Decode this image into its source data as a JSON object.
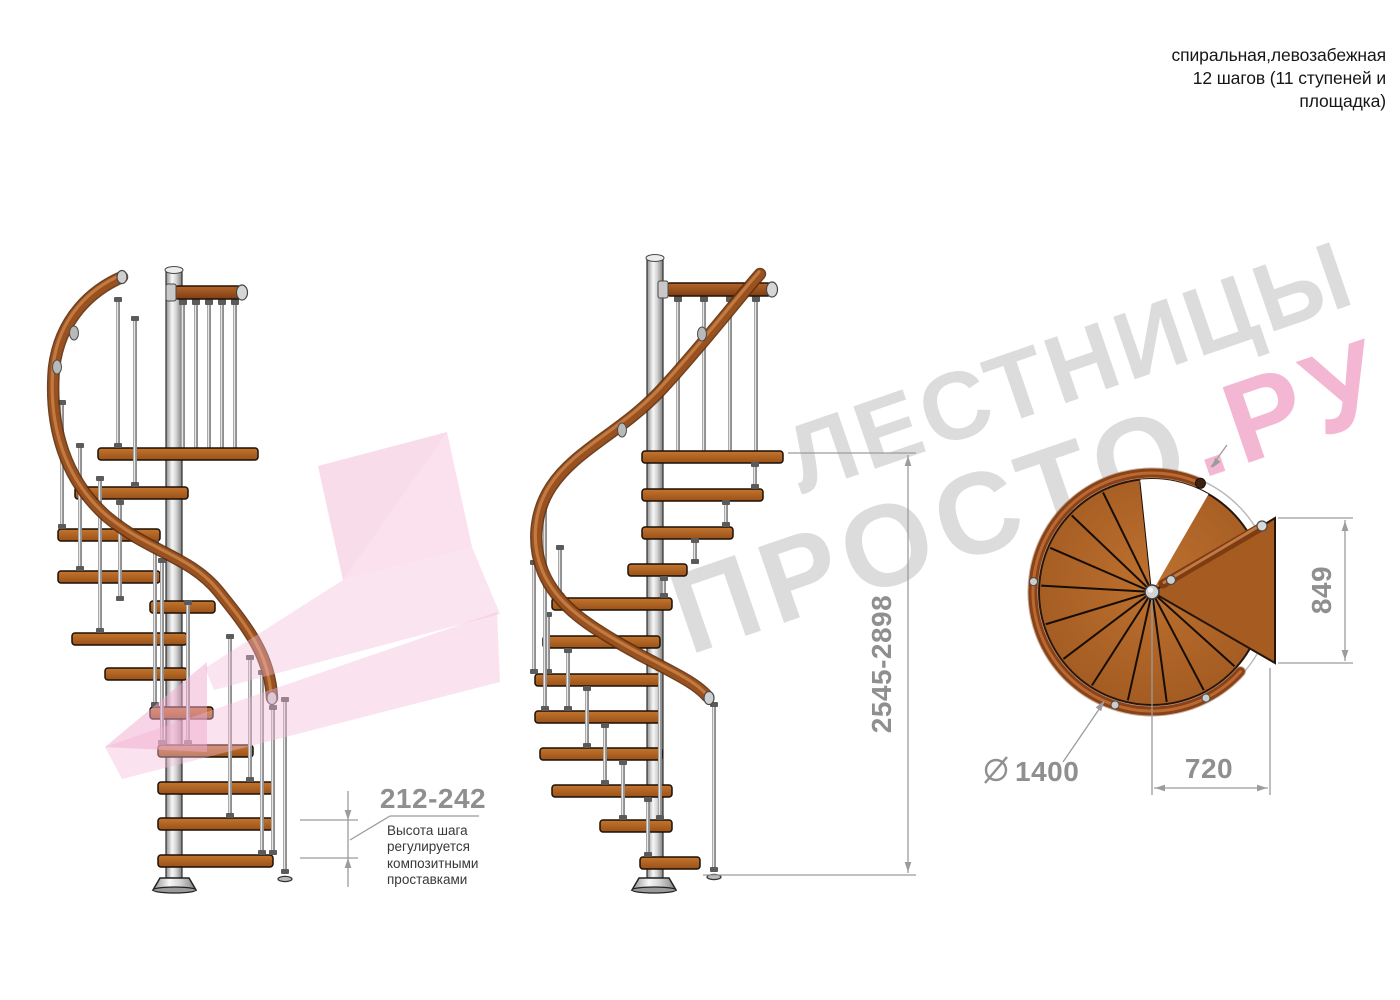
{
  "header": {
    "note": "спиральная,левозабежная\n12 шагов (11 ступеней и\nплощадка)"
  },
  "watermark": {
    "line1": "ЛЕСТНИЦЫ",
    "line2_gray": "ПРОСТО",
    "line2_pink": ".РУ"
  },
  "dimensions": {
    "step_height": "212-242",
    "step_height_note": "Высота шага\nрегулируется\nкомпозитными\nпроставками",
    "total_height": "2545-2898",
    "landing_depth": "849",
    "landing_width": "720",
    "diameter_value": "1400"
  },
  "colors": {
    "wood": "#a8591c",
    "handrail": "#8e4517",
    "metal": "#d0d0d0",
    "dimension_gray": "#9c9c9c",
    "label_gray": "#8f8f8f",
    "watermark_gray": "#dcdcdc",
    "watermark_pink": "#f4b7d3",
    "logo_pink": "#f3bcd8"
  }
}
